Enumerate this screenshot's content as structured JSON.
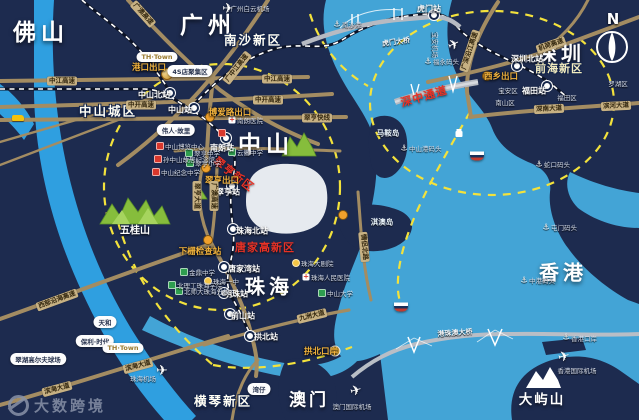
{
  "colors": {
    "bg": "#1d2b4f",
    "bay": "#43a4d6",
    "river": "#2f9fe0",
    "road": "#a38c62",
    "rail": "#0c1326",
    "rail_dash": "#ffffff",
    "dash_yellow": "#f3e23c",
    "exit_gold": "#f2b33d",
    "red": "#e83226",
    "mountain": "#86bd3c",
    "bridge": "#b6bac2",
    "white_area": "#eef2f6"
  },
  "watermark": {
    "text": "大数跨境"
  },
  "compass": {
    "label": "N"
  },
  "labels": [
    {
      "t": "佛山",
      "x": 41,
      "y": 30,
      "c": "city-xl",
      "n": "city-foshan"
    },
    {
      "t": "广州",
      "x": 208,
      "y": 23,
      "c": "city-xl",
      "n": "city-guangzhou"
    },
    {
      "t": "中山",
      "x": 266,
      "y": 142,
      "c": "city-xl",
      "n": "city-zhongshan"
    },
    {
      "t": "深圳",
      "x": 561,
      "y": 52,
      "c": "city-lg",
      "n": "city-shenzhen"
    },
    {
      "t": "珠海",
      "x": 269,
      "y": 285,
      "c": "city-lg",
      "n": "city-zhuhai"
    },
    {
      "t": "香港",
      "x": 563,
      "y": 271,
      "c": "city-lg",
      "n": "city-hongkong"
    },
    {
      "t": "澳门",
      "x": 309,
      "y": 398,
      "c": "city-md2",
      "n": "city-macau"
    },
    {
      "t": "横琴新区",
      "x": 223,
      "y": 400,
      "c": "dist",
      "n": "district-hengqin"
    },
    {
      "t": "大屿山",
      "x": 542,
      "y": 398,
      "c": "city-sm",
      "n": "island-lantau"
    },
    {
      "t": "五桂山",
      "x": 135,
      "y": 229,
      "c": "zone",
      "n": "mountain-wugui-label"
    },
    {
      "t": "南沙新区",
      "x": 253,
      "y": 39,
      "c": "dist",
      "n": "district-nansha"
    },
    {
      "t": "前海新区",
      "x": 559,
      "y": 68,
      "c": "dist-y",
      "n": "district-qianhai"
    },
    {
      "t": "中山城区",
      "x": 108,
      "y": 110,
      "c": "dist",
      "n": "district-zhongshan-city"
    },
    {
      "t": "马鞍岛",
      "x": 388,
      "y": 133,
      "c": "isl",
      "n": "island-maan"
    },
    {
      "t": "淇澳岛",
      "x": 382,
      "y": 222,
      "c": "isl",
      "n": "island-qiao"
    },
    {
      "t": "翠亨新区",
      "x": 234,
      "y": 174,
      "c": "red",
      "r": 38,
      "n": "zone-cuiheng-new-area"
    },
    {
      "t": "深中通道",
      "x": 424,
      "y": 96,
      "c": "red",
      "r": -16,
      "n": "bridge-shenzhong-corridor"
    },
    {
      "t": "唐家高新区",
      "x": 265,
      "y": 247,
      "c": "red",
      "n": "zone-tangjia-hitech"
    },
    {
      "t": "中山北站",
      "x": 154,
      "y": 95,
      "c": "sta",
      "n": "station-zhongshan-north"
    },
    {
      "t": "中山站",
      "x": 180,
      "y": 110,
      "c": "sta",
      "n": "station-zhongshan"
    },
    {
      "t": "南朗站",
      "x": 222,
      "y": 148,
      "c": "sta",
      "n": "station-nanlang"
    },
    {
      "t": "翠亨站",
      "x": 228,
      "y": 192,
      "c": "sta",
      "n": "station-cuiheng"
    },
    {
      "t": "珠海北站",
      "x": 252,
      "y": 231,
      "c": "sta",
      "n": "station-zhuhai-north"
    },
    {
      "t": "唐家湾站",
      "x": 244,
      "y": 269,
      "c": "sta",
      "n": "station-tangjiawan"
    },
    {
      "t": "明珠站",
      "x": 236,
      "y": 294,
      "c": "sta",
      "n": "station-mingzhu"
    },
    {
      "t": "前山站",
      "x": 243,
      "y": 316,
      "c": "sta",
      "n": "station-qianshan"
    },
    {
      "t": "拱北站",
      "x": 266,
      "y": 337,
      "c": "sta",
      "n": "station-gongbei"
    },
    {
      "t": "虎门站",
      "x": 429,
      "y": 9,
      "c": "sta",
      "n": "station-humen"
    },
    {
      "t": "深圳北站",
      "x": 527,
      "y": 59,
      "c": "sta",
      "n": "station-shenzhen-north"
    },
    {
      "t": "福田站",
      "x": 534,
      "y": 91,
      "c": "sta",
      "n": "station-futian"
    },
    {
      "t": "港口出口",
      "x": 149,
      "y": 67,
      "c": "exit",
      "n": "exit-gangkou"
    },
    {
      "t": "博爱路出口",
      "x": 230,
      "y": 112,
      "c": "exit",
      "n": "exit-boailu"
    },
    {
      "t": "翠亨出口",
      "x": 222,
      "y": 180,
      "c": "exit",
      "n": "exit-cuiheng"
    },
    {
      "t": "下栅检查站",
      "x": 200,
      "y": 251,
      "c": "exit",
      "n": "checkpoint-xiazha"
    },
    {
      "t": "西乡出口",
      "x": 501,
      "y": 76,
      "c": "exit",
      "n": "exit-xixiang"
    },
    {
      "t": "拱北口岸",
      "x": 321,
      "y": 351,
      "c": "exit",
      "n": "port-gongbei-gate"
    },
    {
      "t": "中江高速",
      "x": 62,
      "y": 81,
      "c": "road",
      "n": "road-zhongjiang-expwy"
    },
    {
      "t": "中江高速",
      "x": 277,
      "y": 79,
      "c": "road",
      "n": "road-zhongjiang-expwy"
    },
    {
      "t": "广中江高速",
      "x": 237,
      "y": 68,
      "c": "road",
      "r": -52,
      "n": "road-guangzhongjiang-expwy"
    },
    {
      "t": "中开高速",
      "x": 141,
      "y": 105,
      "c": "road",
      "n": "road-zhongkai-expwy"
    },
    {
      "t": "中开高速",
      "x": 268,
      "y": 100,
      "c": "road",
      "n": "road-zhongkai-expwy"
    },
    {
      "t": "翠亨快线",
      "x": 317,
      "y": 118,
      "c": "road",
      "n": "road-cuiheng-express"
    },
    {
      "t": "翠亨大道",
      "x": 197,
      "y": 196,
      "c": "road",
      "r": 90,
      "n": "road-cuiheng-avenue"
    },
    {
      "t": "广澳高速",
      "x": 214,
      "y": 196,
      "c": "road",
      "r": 90,
      "n": "road-guangao-expwy"
    },
    {
      "t": "广澳高速",
      "x": 143,
      "y": 14,
      "c": "road",
      "r": 48,
      "n": "road-guangao-expwy"
    },
    {
      "t": "西部沿海高速",
      "x": 57,
      "y": 300,
      "c": "road",
      "r": -20,
      "n": "road-west-coastal-expwy"
    },
    {
      "t": "滨海大道",
      "x": 138,
      "y": 366,
      "c": "road",
      "r": -15,
      "n": "road-binhai-avenue"
    },
    {
      "t": "滨海大道",
      "x": 57,
      "y": 389,
      "c": "road",
      "r": -15,
      "n": "road-binhai-avenue"
    },
    {
      "t": "九洲大道",
      "x": 312,
      "y": 316,
      "c": "road",
      "r": -14,
      "n": "road-jiuzhou-avenue"
    },
    {
      "t": "情侣北路",
      "x": 364,
      "y": 247,
      "c": "road",
      "r": 85,
      "n": "road-qinglv-north"
    },
    {
      "t": "广深沿江高速",
      "x": 470,
      "y": 51,
      "c": "road",
      "r": -72,
      "n": "road-guangshen-riverside-expwy"
    },
    {
      "t": "机荷高速",
      "x": 551,
      "y": 45,
      "c": "road",
      "r": -19,
      "n": "road-jihe-expwy"
    },
    {
      "t": "深南大道",
      "x": 549,
      "y": 109,
      "c": "road",
      "r": -3,
      "n": "road-shennan-avenue"
    },
    {
      "t": "滨河大道",
      "x": 616,
      "y": 106,
      "c": "road",
      "r": -3,
      "n": "road-binhe-avenue"
    },
    {
      "t": "虎门大桥",
      "x": 396,
      "y": 42,
      "c": "bridge-lbl",
      "r": -8,
      "n": "bridge-humen-label"
    },
    {
      "t": "港珠澳大桥",
      "x": 455,
      "y": 333,
      "c": "bridge-lbl",
      "r": -4,
      "n": "bridge-hzmb-label"
    },
    {
      "t": "广州白云机场",
      "x": 250,
      "y": 8,
      "c": "poi",
      "n": "airport-baiyun-label"
    },
    {
      "t": "宝安机场",
      "x": 436,
      "y": 45,
      "c": "poi",
      "r": 90,
      "n": "airport-baoan-label"
    },
    {
      "t": "珠海机场",
      "x": 143,
      "y": 378,
      "c": "poi",
      "n": "airport-zhuhai-label"
    },
    {
      "t": "澳门国际机场",
      "x": 352,
      "y": 406,
      "c": "poi",
      "n": "airport-macau-label"
    },
    {
      "t": "香港国际机场",
      "x": 577,
      "y": 370,
      "c": "poi",
      "n": "airport-hongkong-label"
    },
    {
      "t": "福永码头",
      "x": 433,
      "y": 61,
      "c": "poi",
      "a": "l",
      "n": "port-fuyong"
    },
    {
      "t": "蛇口码头",
      "x": 544,
      "y": 164,
      "c": "poi",
      "a": "l",
      "n": "port-shekou"
    },
    {
      "t": "屯门码头",
      "x": 551,
      "y": 227,
      "c": "poi",
      "a": "l",
      "n": "port-tuenmun"
    },
    {
      "t": "中港码头",
      "x": 529,
      "y": 280,
      "c": "poi",
      "a": "l",
      "n": "port-zhonggang"
    },
    {
      "t": "香港口岸",
      "x": 571,
      "y": 338,
      "c": "poi",
      "a": "l",
      "n": "port-hongkong-gate"
    },
    {
      "t": "中山港码头",
      "x": 409,
      "y": 148,
      "c": "poi",
      "a": "l",
      "n": "port-zhongshan"
    },
    {
      "t": "南沙港",
      "x": 342,
      "y": 24,
      "c": "poi",
      "a": "l",
      "n": "port-nansha"
    },
    {
      "t": "宝安区",
      "x": 508,
      "y": 90,
      "c": "poi",
      "n": "area-baoan"
    },
    {
      "t": "南山区",
      "x": 505,
      "y": 102,
      "c": "poi",
      "n": "area-nanshan"
    },
    {
      "t": "福田区",
      "x": 567,
      "y": 97,
      "c": "poi",
      "n": "area-futian"
    },
    {
      "t": "罗湖区",
      "x": 618,
      "y": 83,
      "c": "poi",
      "n": "area-luohu"
    },
    {
      "t": "中山博览中心",
      "x": 165,
      "y": 146,
      "c": "poi",
      "a": "l",
      "n": "poi-zhongshan-expo"
    },
    {
      "t": "孙中山故居纪念馆",
      "x": 163,
      "y": 159,
      "c": "poi",
      "a": "l",
      "n": "poi-sunyatsen-residence"
    },
    {
      "t": "中山纪念中学",
      "x": 161,
      "y": 172,
      "c": "poi",
      "a": "l",
      "n": "poi-zhongshan-memorial-school"
    },
    {
      "t": "翠亨中学",
      "x": 194,
      "y": 153,
      "c": "poi",
      "a": "l",
      "n": "poi-cuiheng-middle-school"
    },
    {
      "t": "翠亨小学",
      "x": 195,
      "y": 163,
      "c": "poi",
      "a": "l",
      "n": "poi-cuiheng-primary-school"
    },
    {
      "t": "云衢中学",
      "x": 237,
      "y": 152,
      "c": "poi",
      "a": "l",
      "n": "poi-yunqu-school"
    },
    {
      "t": "南朗医院",
      "x": 237,
      "y": 120,
      "c": "poi",
      "a": "l",
      "n": "poi-nanlang-hospital"
    },
    {
      "t": "金鼎中学",
      "x": 189,
      "y": 272,
      "c": "poi",
      "a": "l",
      "n": "poi-jinding-school"
    },
    {
      "t": "北理工珠海学院",
      "x": 177,
      "y": 285,
      "c": "poi",
      "a": "l",
      "n": "poi-bit-zhuhai"
    },
    {
      "t": "北师大珠海分校",
      "x": 184,
      "y": 291,
      "c": "poi",
      "a": "l",
      "n": "poi-bnu-zhuhai"
    },
    {
      "t": "珠海一中",
      "x": 213,
      "y": 281,
      "c": "poi",
      "a": "l",
      "n": "poi-zhuhai-no1-school"
    },
    {
      "t": "中山大学",
      "x": 327,
      "y": 293,
      "c": "poi",
      "a": "l",
      "n": "poi-sun-yatsen-university"
    },
    {
      "t": "珠海大剧院",
      "x": 301,
      "y": 263,
      "c": "poi",
      "a": "l",
      "n": "poi-zhuhai-opera"
    },
    {
      "t": "珠海人民医院",
      "x": 311,
      "y": 277,
      "c": "poi",
      "a": "l",
      "n": "poi-zhuhai-hospital"
    },
    {
      "t": "天和",
      "x": 105,
      "y": 322,
      "c": "pill",
      "n": "estate-tianhe"
    },
    {
      "t": "保利·时代",
      "x": 95,
      "y": 341,
      "c": "pill",
      "n": "estate-poly-times"
    },
    {
      "t": "TH·Town",
      "x": 123,
      "y": 348,
      "c": "pill-logo",
      "n": "estate-th-town"
    },
    {
      "t": "TH·Town",
      "x": 157,
      "y": 57,
      "c": "pill-logo",
      "n": "estate-th-town"
    },
    {
      "t": "伟人·故里",
      "x": 176,
      "y": 130,
      "c": "pill",
      "n": "tag-hometown"
    },
    {
      "t": "4S店聚集区",
      "x": 190,
      "y": 71,
      "c": "pill",
      "n": "tag-4s-zone"
    },
    {
      "t": "翠湖高尔夫球场",
      "x": 38,
      "y": 359,
      "c": "pill",
      "n": "poi-golf-course"
    },
    {
      "t": "湾仔",
      "x": 259,
      "y": 389,
      "c": "pill",
      "n": "port-wanzai"
    },
    {
      "t": "N",
      "x": 613,
      "y": 19,
      "c": "compass-n",
      "n": "compass-north-label"
    }
  ],
  "markers": [
    {
      "k": "station",
      "x": 170,
      "y": 93
    },
    {
      "k": "station",
      "x": 194,
      "y": 108
    },
    {
      "k": "station",
      "x": 226,
      "y": 138
    },
    {
      "k": "station",
      "x": 232,
      "y": 186
    },
    {
      "k": "station",
      "x": 233,
      "y": 229
    },
    {
      "k": "station",
      "x": 224,
      "y": 267
    },
    {
      "k": "station",
      "x": 224,
      "y": 293
    },
    {
      "k": "station",
      "x": 230,
      "y": 314
    },
    {
      "k": "station",
      "x": 250,
      "y": 336
    },
    {
      "k": "station",
      "x": 434,
      "y": 15
    },
    {
      "k": "station",
      "x": 517,
      "y": 66
    },
    {
      "k": "station",
      "x": 547,
      "y": 86
    },
    {
      "k": "exitdot",
      "x": 210,
      "y": 117
    },
    {
      "k": "exitdot",
      "x": 206,
      "y": 168
    },
    {
      "k": "exitdot",
      "x": 208,
      "y": 240
    },
    {
      "k": "exitdot",
      "x": 487,
      "y": 76
    },
    {
      "k": "exitdot",
      "x": 343,
      "y": 215
    },
    {
      "k": "emblem",
      "x": 167,
      "y": 74
    },
    {
      "k": "gate",
      "x": 335,
      "y": 351
    },
    {
      "k": "poi-red",
      "x": 160,
      "y": 146
    },
    {
      "k": "poi-red",
      "x": 158,
      "y": 159
    },
    {
      "k": "poi-red",
      "x": 156,
      "y": 172
    },
    {
      "k": "poi-red",
      "x": 222,
      "y": 133
    },
    {
      "k": "poi-green",
      "x": 189,
      "y": 153
    },
    {
      "k": "poi-green",
      "x": 190,
      "y": 163
    },
    {
      "k": "poi-green",
      "x": 232,
      "y": 152
    },
    {
      "k": "poi-green",
      "x": 184,
      "y": 272
    },
    {
      "k": "poi-green",
      "x": 172,
      "y": 285
    },
    {
      "k": "poi-green",
      "x": 179,
      "y": 291
    },
    {
      "k": "poi-green",
      "x": 322,
      "y": 293
    },
    {
      "k": "poi-yellow",
      "x": 208,
      "y": 281
    },
    {
      "k": "poi-yellow",
      "x": 296,
      "y": 263
    },
    {
      "k": "hospital",
      "x": 232,
      "y": 120,
      "g": "+"
    },
    {
      "k": "hospital",
      "x": 306,
      "y": 277,
      "g": "+"
    },
    {
      "k": "anchor",
      "x": 428,
      "y": 61,
      "g": "⚓"
    },
    {
      "k": "anchor",
      "x": 539,
      "y": 164,
      "g": "⚓"
    },
    {
      "k": "anchor",
      "x": 546,
      "y": 227,
      "g": "⚓"
    },
    {
      "k": "anchor",
      "x": 524,
      "y": 280,
      "g": "⚓"
    },
    {
      "k": "anchor",
      "x": 566,
      "y": 337,
      "g": "⚓"
    },
    {
      "k": "anchor",
      "x": 404,
      "y": 148,
      "g": "⚓"
    },
    {
      "k": "anchor",
      "x": 337,
      "y": 24,
      "g": "⚓"
    },
    {
      "k": "plane",
      "x": 228,
      "y": 9,
      "g": "✈"
    },
    {
      "k": "plane",
      "x": 454,
      "y": 45,
      "g": "✈",
      "r": -25
    },
    {
      "k": "plane",
      "x": 162,
      "y": 371,
      "g": "✈"
    },
    {
      "k": "plane",
      "x": 356,
      "y": 391,
      "g": "✈",
      "r": -15
    },
    {
      "k": "plane",
      "x": 564,
      "y": 357,
      "g": "✈",
      "r": -15
    },
    {
      "k": "ship",
      "x": 477,
      "y": 156
    },
    {
      "k": "ship",
      "x": 401,
      "y": 307
    },
    {
      "k": "cablecar",
      "x": 459,
      "y": 134
    },
    {
      "k": "car",
      "x": 18,
      "y": 118
    }
  ]
}
